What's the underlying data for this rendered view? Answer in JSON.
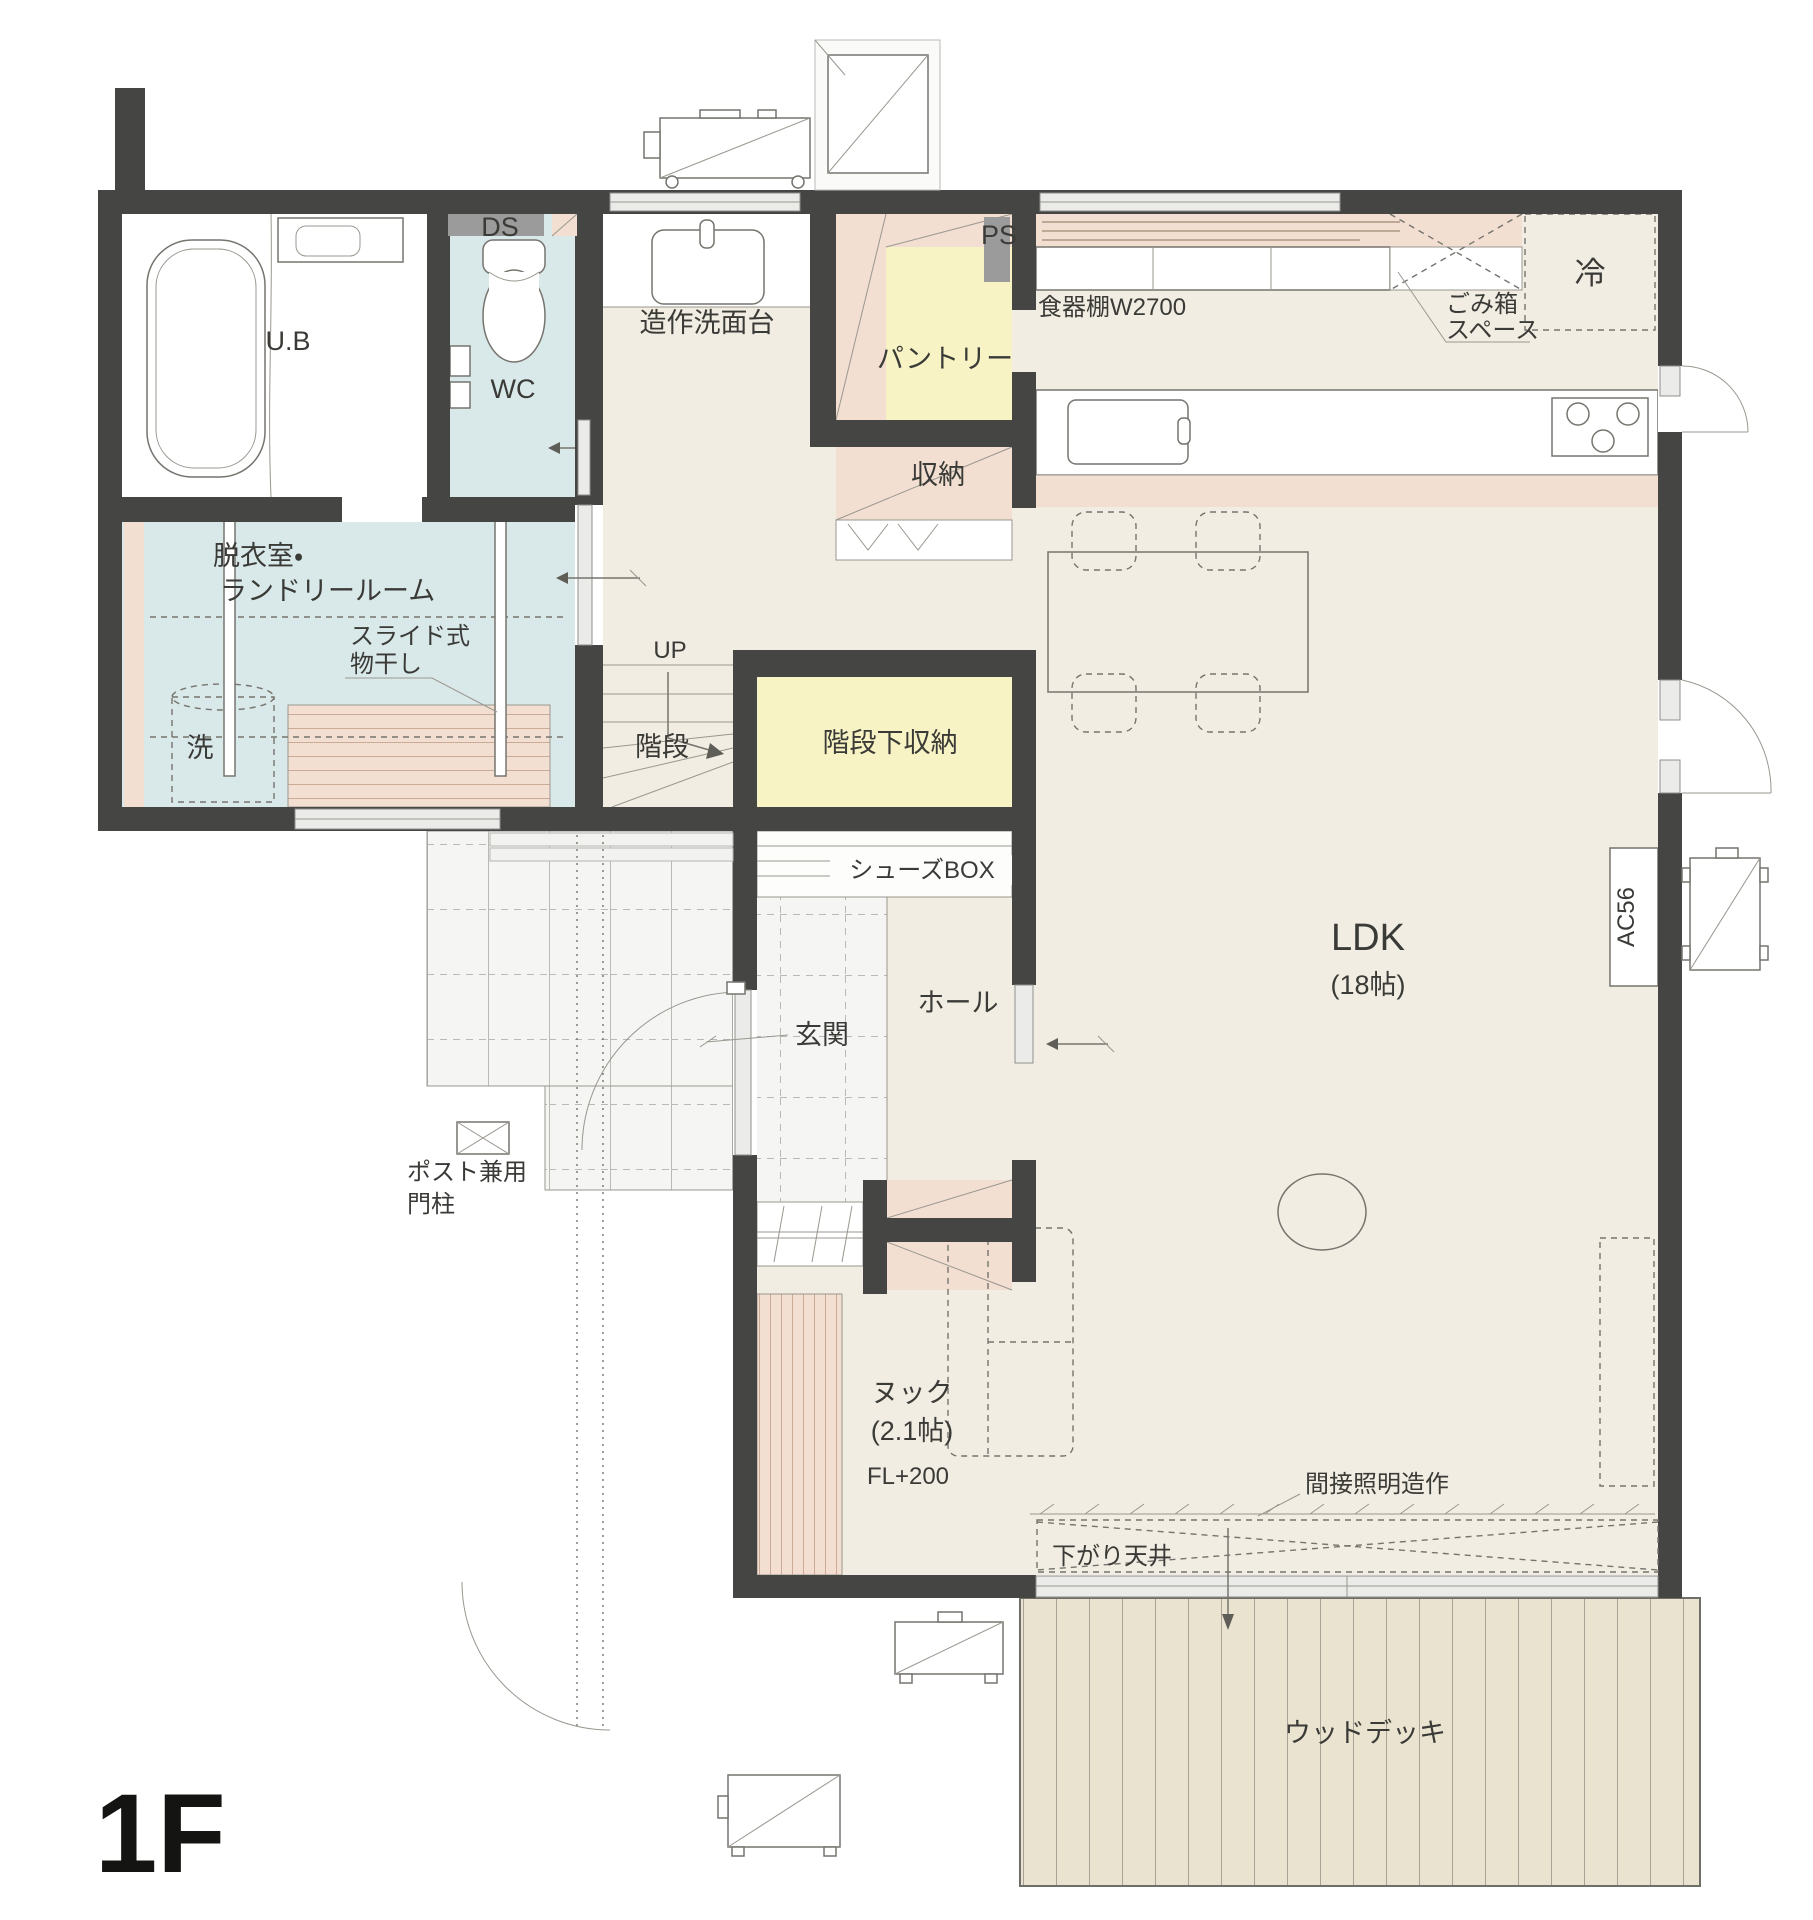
{
  "plan": {
    "floor_label": "1F",
    "colors": {
      "wall": "#454543",
      "floor_beige": "#f1ede2",
      "wet_room_blue": "#d9e8e9",
      "storage_yellow": "#f8f3c5",
      "shelf_pink": "#f2dfd2",
      "deck_tan": "#eae3cf",
      "duct_gray": "#9b9b9b"
    },
    "rooms": {
      "ub": "U.B",
      "wc": "WC",
      "ds": "DS",
      "ps": "PS",
      "washbasin": "造作洗面台",
      "pantry": "パントリー",
      "cupboard": "食器棚W2700",
      "trash_line1": "ごみ箱",
      "trash_line2": "スペース",
      "fridge": "冷",
      "storage": "収納",
      "laundry_line1": "脱衣室・",
      "laundry_line2": "ランドリールーム",
      "slide_line1": "スライド式",
      "slide_line2": "物干し",
      "washer": "洗",
      "up": "UP",
      "stairs": "階段",
      "under_stair": "階段下収納",
      "shoes_box": "シューズBOX",
      "entrance": "玄関",
      "hall": "ホール",
      "ldk": "LDK",
      "ldk_size": "(18帖)",
      "ac": "AC56",
      "post_line1": "ポスト兼用",
      "post_line2": "門柱",
      "nook": "ヌック",
      "nook_size": "(2.1帖)",
      "nook_fl": "FL+200",
      "indirect_light": "間接照明造作",
      "lowered_ceiling": "下がり天井",
      "wood_deck": "ウッドデッキ"
    }
  }
}
